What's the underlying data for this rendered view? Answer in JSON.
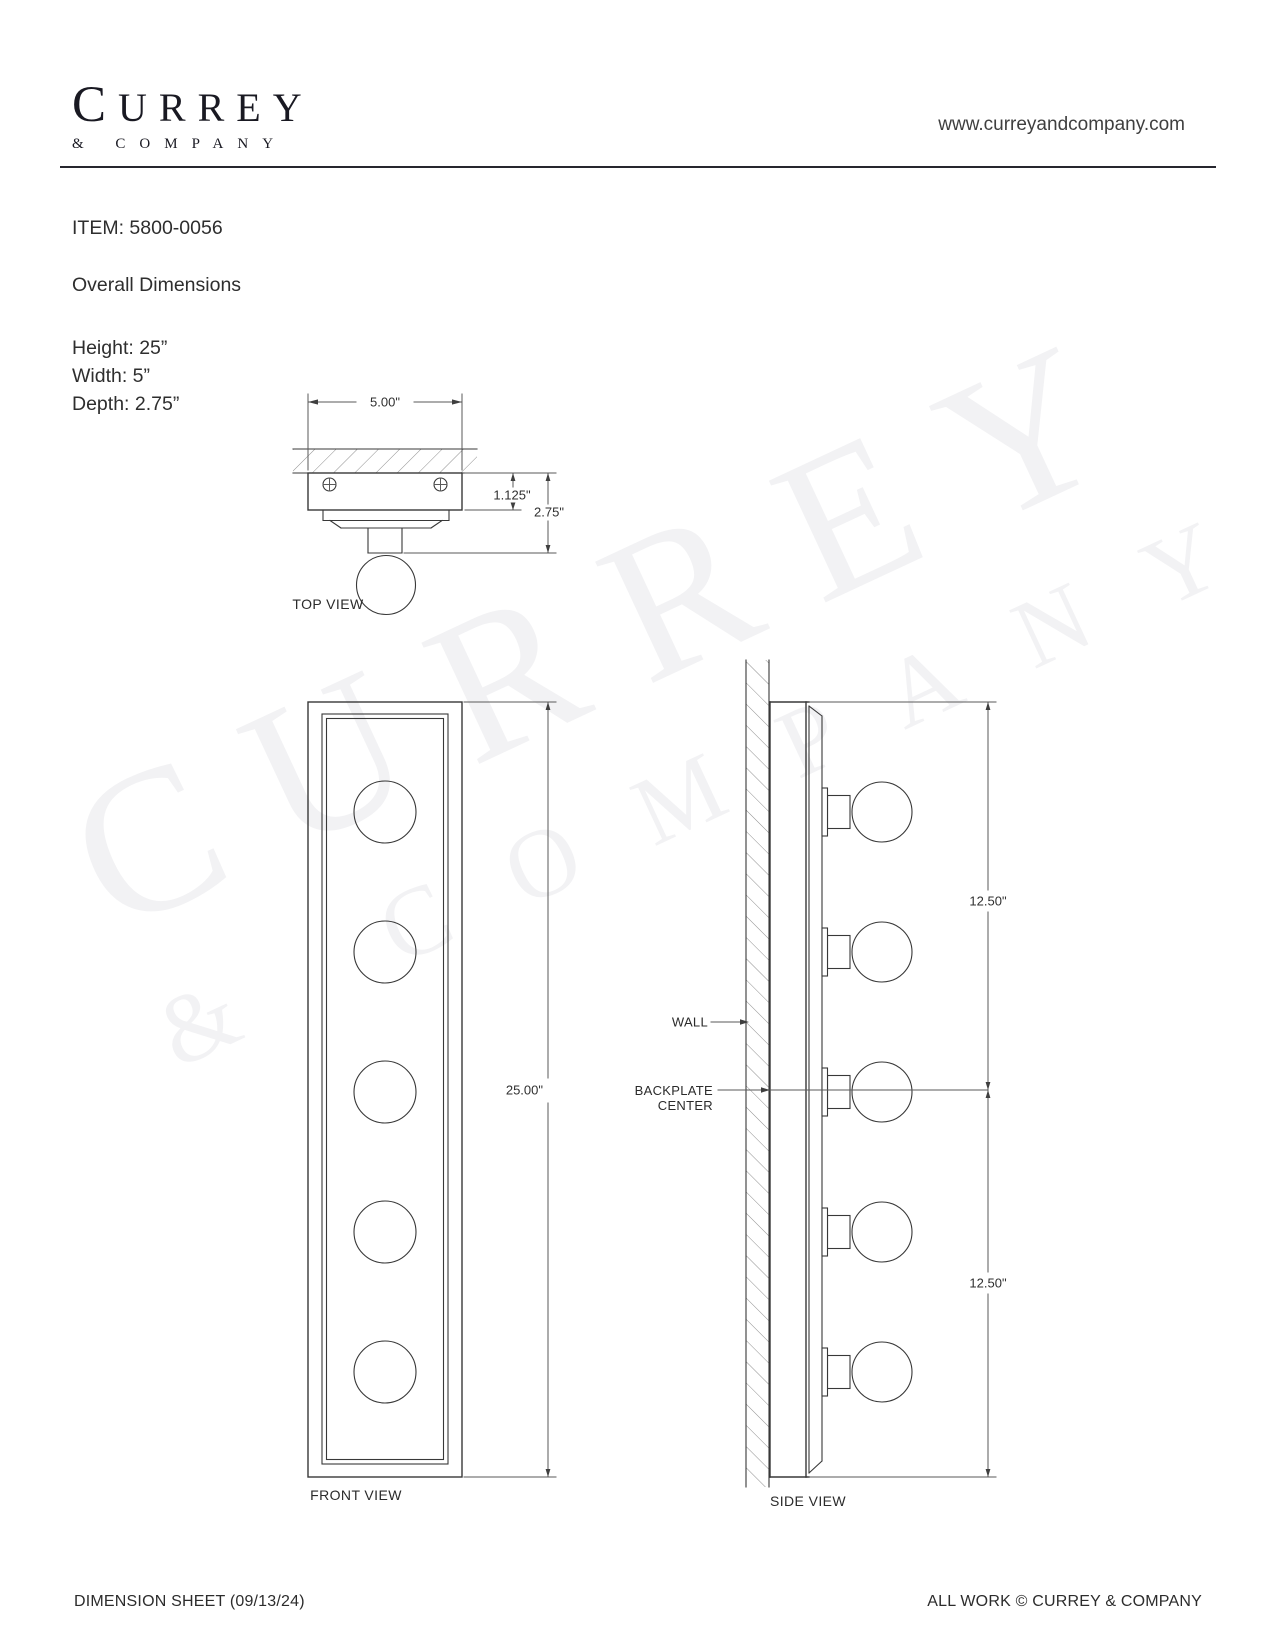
{
  "header": {
    "logo_main": "CURREY",
    "logo_sub": "& COMPANY",
    "website": "www.curreyandcompany.com"
  },
  "product": {
    "item_label": "ITEM: 5800-0056",
    "section_title": "Overall Dimensions",
    "height": "Height: 25”",
    "width": "Width: 5”",
    "depth": "Depth: 2.75”"
  },
  "top_view": {
    "label": "TOP VIEW",
    "dim_width": "5.00\"",
    "dim_backplate_depth": "1.125\"",
    "dim_overall_depth": "2.75\""
  },
  "front_view": {
    "label": "FRONT VIEW",
    "dim_height": "25.00\""
  },
  "side_view": {
    "label": "SIDE VIEW",
    "dim_upper": "12.50\"",
    "dim_lower": "12.50\"",
    "wall_label": "WALL",
    "backplate_label_line1": "BACKPLATE",
    "backplate_label_line2": "CENTER"
  },
  "watermark": {
    "line1": "CURREY",
    "line2": "& COMPANY"
  },
  "footer": {
    "left": "DIMENSION SHEET (09/13/24)",
    "right": "ALL WORK © CURREY & COMPANY"
  },
  "colors": {
    "line": "#383838",
    "text": "#2e2e2e",
    "logo": "#191922"
  }
}
